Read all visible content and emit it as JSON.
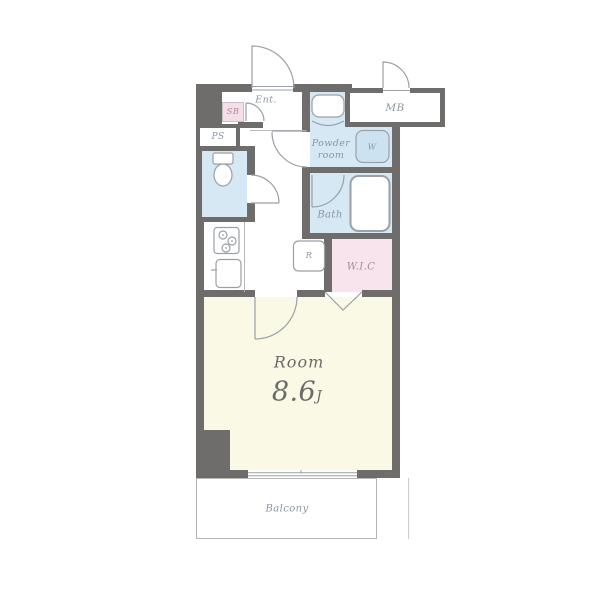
{
  "rooms": {
    "entrance": {
      "label": "Ent."
    },
    "shoe_box": {
      "label": "SB"
    },
    "meter_box": {
      "label": "MB"
    },
    "pipe_space": {
      "label": "PS"
    },
    "powder_room": {
      "label_line1": "Powder",
      "label_line2": "room"
    },
    "washer": {
      "label": "W"
    },
    "bath": {
      "label": "Bath"
    },
    "refrigerator": {
      "label": "R"
    },
    "walk_in_closet": {
      "label": "W.I.C"
    },
    "main_room": {
      "label": "Room",
      "size_value": "8.6",
      "size_unit": "J"
    },
    "balcony": {
      "label": "Balcony"
    }
  },
  "colors": {
    "wall": "#6e6d6b",
    "water_room_fill": "#d5e8f4",
    "washer_fill": "#cde2f1",
    "closet_fill": "#f8e4ed",
    "shoe_box_fill": "#f6dee8",
    "main_room_fill": "#faf9e6",
    "line": "#9aa0a6",
    "label_text": "#8d96a3",
    "room_text": "#6b6b6b",
    "sb_text": "#b88a9a",
    "wic_text": "#9b8f9b"
  }
}
